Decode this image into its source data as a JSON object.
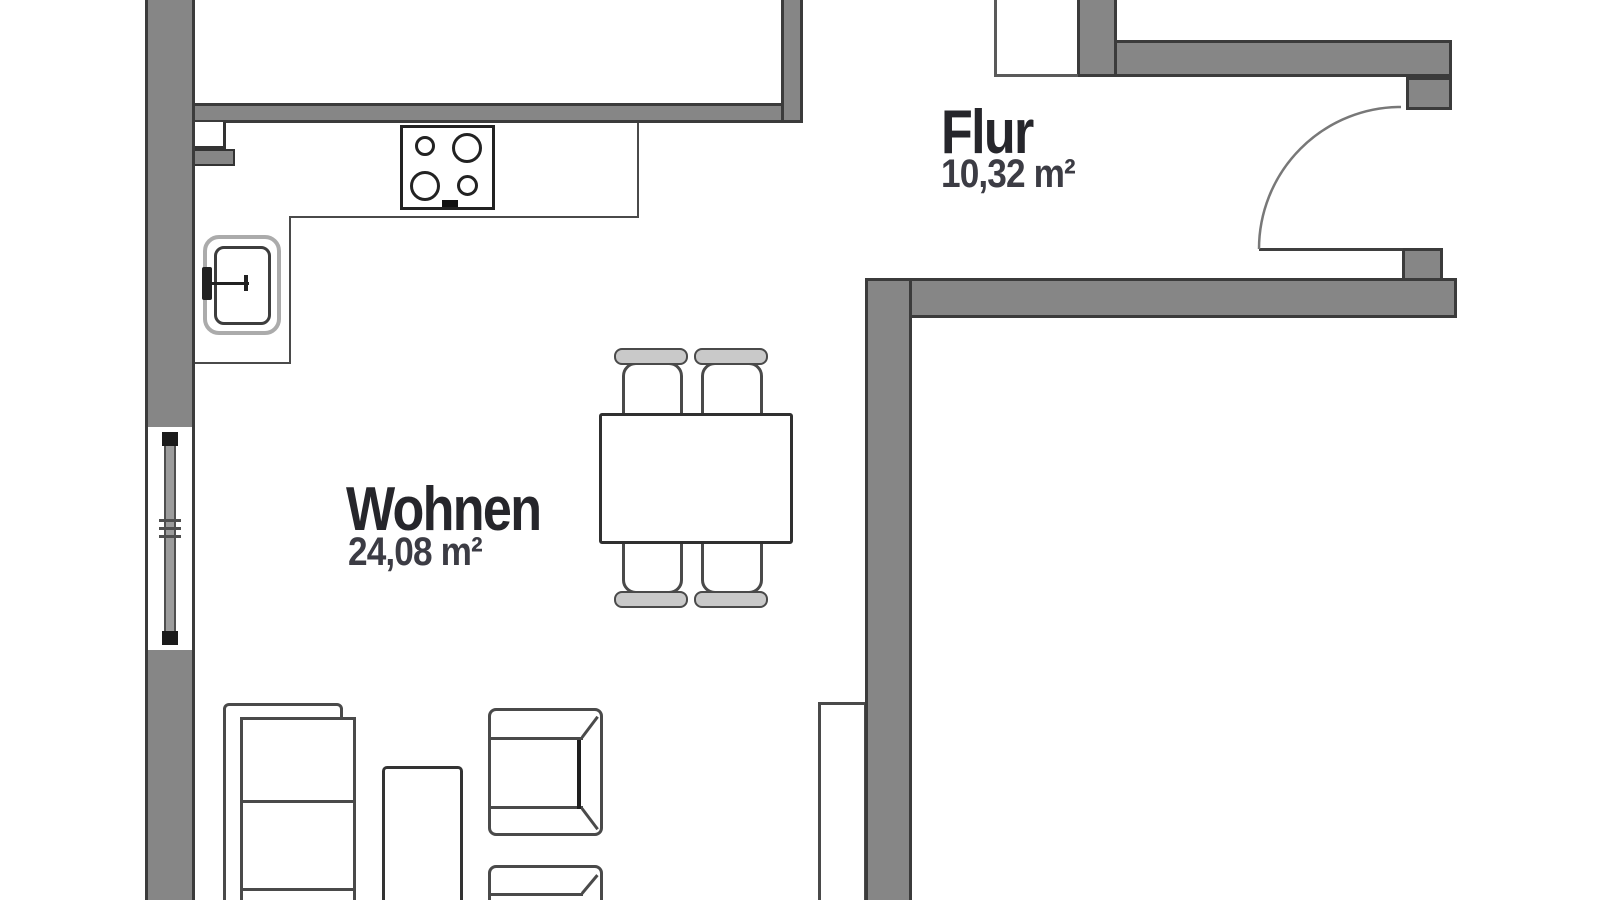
{
  "rooms": [
    {
      "name": "Flur",
      "area": "10,32 m²"
    },
    {
      "name": "Wohnen",
      "area": "24,08 m²"
    }
  ],
  "colors": {
    "wall_fill": "#868686",
    "wall_outline": "#3b3b3b",
    "furniture_line": "#4a4a4a",
    "label_text": "#26262b",
    "area_text": "#3c3c44"
  }
}
